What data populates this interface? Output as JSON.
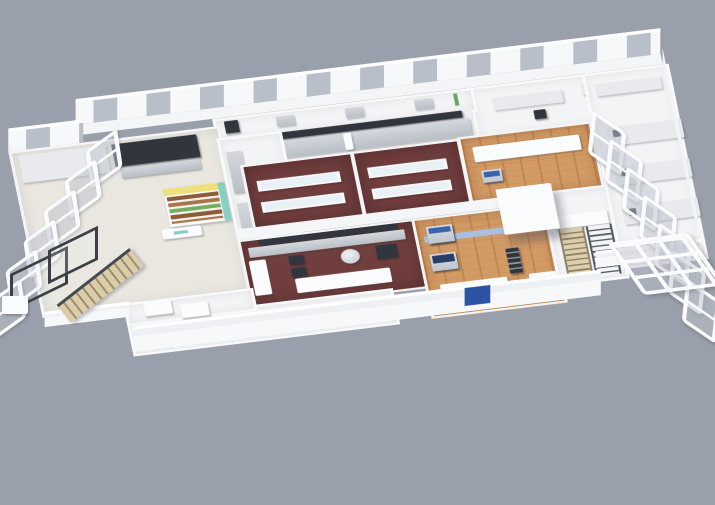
{
  "meta": {
    "title": "3D isometric cutaway floor-plan render of a food-service and food-processing facility",
    "view": "isometric cutaway, roof removed, on plain gray backdrop",
    "visible_text": "none (tiny illegible teal logo mark on retail counter)"
  },
  "canvas": {
    "width": 715,
    "height": 505
  },
  "palette": {
    "bg": "#9aa0ab",
    "white_bright": "#fbfcfd",
    "floor_light": "#e9e7e0",
    "floor_maroon": "#713e3e",
    "floor_wood": "#d29a64",
    "steel": "#c7ccd2",
    "dark": "#31363e",
    "blue": "#3a63ac",
    "navy": "#2a3f68",
    "blue_light": "#aabfdf",
    "yellow": "#eee17b",
    "teal": "#87cfc4",
    "green": "#69a85f",
    "tan": "#d9cba6",
    "rail": "#3b4048",
    "glass": "#b9bfc9",
    "facade_blue": "#2d54a4"
  },
  "rooms": [
    {
      "id": "dining-hall",
      "label": "Dining hall with grid of white tables"
    },
    {
      "id": "retail-shelf",
      "label": "Yellow retail shelf display with teal end caps"
    },
    {
      "id": "prep-area",
      "label": "Prep area with dark equipment"
    },
    {
      "id": "service-corridor",
      "label": "Service corridor with stainless counters"
    },
    {
      "id": "back-corridor",
      "label": "Back corridor along window wall"
    },
    {
      "id": "cook-line",
      "label": "Stainless cooking line with dark hood"
    },
    {
      "id": "demo-kitchen-a",
      "label": "Demo kitchen A, maroon floor, service counters"
    },
    {
      "id": "demo-kitchen-b",
      "label": "Demo kitchen B, maroon floor, service counters"
    },
    {
      "id": "main-kitchen",
      "label": "Main kitchen, maroon floor, stainless equipment"
    },
    {
      "id": "service-walkway",
      "label": "Front service walkway with pass counters"
    },
    {
      "id": "processing-hall",
      "label": "Wood-floor processing hall with blue machinery lines"
    },
    {
      "id": "processing-annex",
      "label": "Wood-floor processing annex"
    },
    {
      "id": "instrument-room",
      "label": "White instrument room"
    },
    {
      "id": "stair-hall",
      "label": "Stair hall with two staircases"
    },
    {
      "id": "lab-wing",
      "label": "Laboratory wing with bench rows"
    },
    {
      "id": "cold-room",
      "label": "Tall white cold room / elevator block"
    },
    {
      "id": "front-facade",
      "label": "White front facade wall with blue stripe"
    },
    {
      "id": "entry-area",
      "label": "Entry area with two white tables"
    }
  ],
  "counts": {
    "dining_tables": 20,
    "processing_line_machines": 4,
    "packing_line_machines": 3,
    "annex_machines": 3,
    "left_window_panels": 6,
    "right_window_panels": 7,
    "walkway_counters": 3,
    "lab_bench_dots": 3
  }
}
